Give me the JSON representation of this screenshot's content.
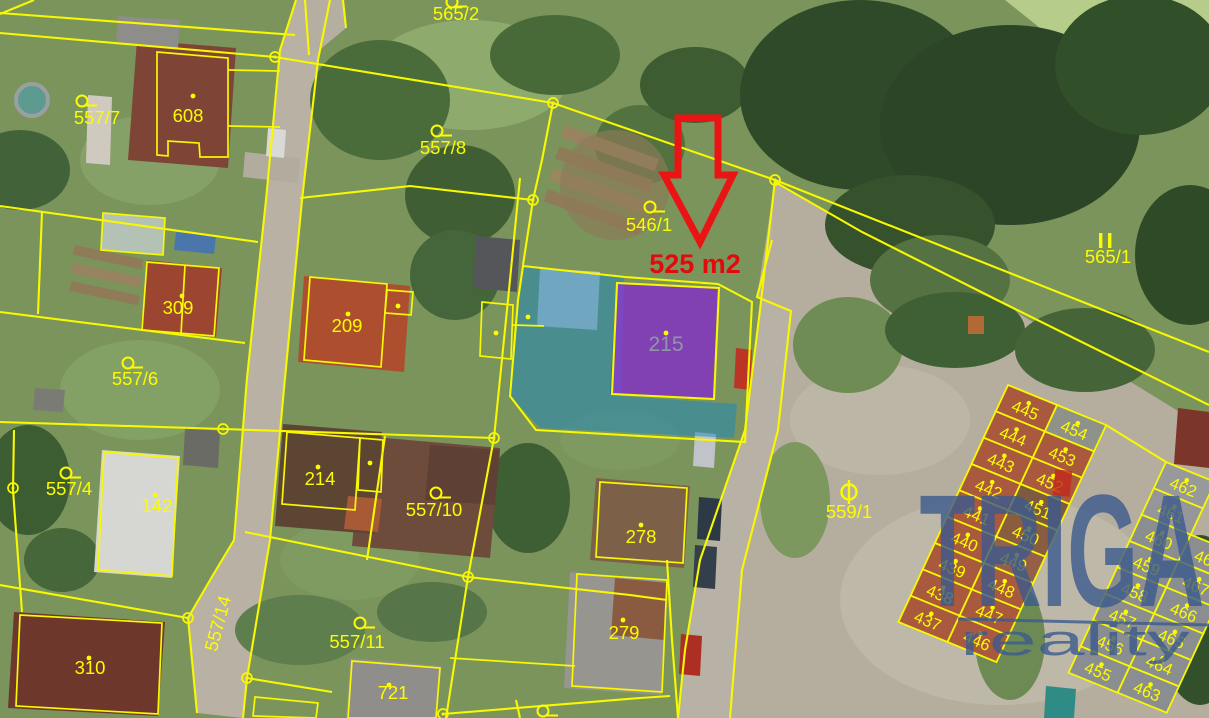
{
  "watermark": {
    "brand": "TRIGA",
    "sub": "reality",
    "color": "#3c5a8e",
    "accent": "#c2291d"
  },
  "highlight": {
    "area_text": "525 m2",
    "text_color": "#e10b0b",
    "arrow_color": "#ea1414"
  },
  "map": {
    "line_color": "#f8f800",
    "label_color": "#fcfc00",
    "labels": [
      {
        "t": "565/2",
        "x": 456,
        "y": 20,
        "s": "ring",
        "sx": 452,
        "sy": 2
      },
      {
        "t": "557/7",
        "x": 97,
        "y": 124,
        "s": "ring",
        "sx": 82,
        "sy": 101
      },
      {
        "t": "557/8",
        "x": 443,
        "y": 154,
        "s": "ring",
        "sx": 437,
        "sy": 131
      },
      {
        "t": "546/1",
        "x": 649,
        "y": 231,
        "s": "ring",
        "sx": 650,
        "sy": 207
      },
      {
        "t": "565/1",
        "x": 1108,
        "y": 263,
        "s": "bars",
        "sx": 1105,
        "sy": 241
      },
      {
        "t": "557/6",
        "x": 135,
        "y": 385,
        "s": "ring",
        "sx": 128,
        "sy": 363
      },
      {
        "t": "557/4",
        "x": 69,
        "y": 495,
        "s": "ring",
        "sx": 66,
        "sy": 473
      },
      {
        "t": "557/10",
        "x": 434,
        "y": 516,
        "s": "ring",
        "sx": 436,
        "sy": 493
      },
      {
        "t": "557/11",
        "x": 357,
        "y": 648,
        "s": "ring",
        "sx": 360,
        "sy": 623
      },
      {
        "t": "559/1",
        "x": 849,
        "y": 518,
        "s": "circle-bar",
        "sx": 849,
        "sy": 492
      },
      {
        "t": "557/14",
        "x": 224,
        "y": 625,
        "rot": -75
      },
      {
        "t": "608",
        "x": 188,
        "y": 122,
        "s": "dot",
        "sx": 193,
        "sy": 96
      },
      {
        "t": "309",
        "x": 178,
        "y": 314,
        "s": "dot",
        "sx": 182,
        "sy": 296
      },
      {
        "t": "209",
        "x": 347,
        "y": 332,
        "s": "dot",
        "sx": 348,
        "sy": 314
      },
      {
        "t": "215",
        "x": 666,
        "y": 351,
        "s": "dot",
        "sx": 666,
        "sy": 333,
        "c": "#8f97a6",
        "fs": 21
      },
      {
        "t": "142",
        "x": 157,
        "y": 512,
        "s": "dot",
        "sx": 155,
        "sy": 495
      },
      {
        "t": "214",
        "x": 320,
        "y": 485,
        "s": "dot",
        "sx": 318,
        "sy": 467
      },
      {
        "t": "278",
        "x": 641,
        "y": 543,
        "s": "dot",
        "sx": 641,
        "sy": 525
      },
      {
        "t": "279",
        "x": 624,
        "y": 639,
        "s": "dot",
        "sx": 623,
        "sy": 620
      },
      {
        "t": "721",
        "x": 393,
        "y": 699,
        "s": "dot",
        "sx": 389,
        "sy": 685
      },
      {
        "t": "310",
        "x": 90,
        "y": 674,
        "s": "dot",
        "sx": 89,
        "sy": 658
      },
      {
        "t": "",
        "x": 543,
        "y": 724,
        "s": "ring",
        "sx": 543,
        "sy": 711
      }
    ],
    "extra_dots": [
      [
        496,
        333
      ],
      [
        528,
        317
      ],
      [
        370,
        463
      ],
      [
        398,
        306
      ]
    ],
    "nodes": [
      [
        275,
        57
      ],
      [
        553,
        103
      ],
      [
        775,
        180
      ],
      [
        223,
        429
      ],
      [
        494,
        438
      ],
      [
        468,
        577
      ],
      [
        188,
        618
      ],
      [
        247,
        678
      ],
      [
        13,
        488
      ],
      [
        443,
        714
      ],
      [
        533,
        200
      ]
    ],
    "boundaries": [
      {
        "p": "0,13 295,35"
      },
      {
        "p": "0,33 275,57 553,103 775,180"
      },
      {
        "p": "775,180 1209,352"
      },
      {
        "p": "775,182 862,232 997,300 1209,405"
      },
      {
        "p": "296,0 280,50 266,200 247,378 234,540 213,575 188,618 197,713"
      },
      {
        "p": "330,0 318,60 302,200 285,378 270,540 247,678 243,718"
      },
      {
        "p": "0,206 258,242"
      },
      {
        "p": "0,312 245,343"
      },
      {
        "p": "0,422 223,429 494,438"
      },
      {
        "p": "0,585 188,618"
      },
      {
        "p": "14,430 13,490 22,612"
      },
      {
        "p": "157,52 228,58 228,157 200,157 199,143 168,141 168,156 157,155",
        "closed": true,
        "w": 1.7
      },
      {
        "p": "228,70 280,71",
        "w": 1.7
      },
      {
        "p": "228,126 280,127",
        "w": 1.7
      },
      {
        "p": "103,213 165,218 163,255 101,250",
        "closed": true,
        "w": 1.7
      },
      {
        "p": "42,212 38,314"
      },
      {
        "p": "147,262 219,268 214,336 142,330",
        "closed": true,
        "w": 1.7
      },
      {
        "p": "185,265 181,334",
        "w": 1.7
      },
      {
        "p": "310,277 387,284 381,367 304,360",
        "closed": true,
        "w": 1.7
      },
      {
        "p": "387,290 413,292 411,315 385,313",
        "closed": true,
        "w": 1.7
      },
      {
        "p": "300,198 410,186 533,200"
      },
      {
        "p": "520,178 508,300 494,438 468,577 446,718"
      },
      {
        "p": "553,103 542,160 533,200 523,265"
      },
      {
        "p": "523,266 625,277 718,284 752,302 745,442 536,430 510,396 518,300",
        "closed": true
      },
      {
        "p": "617,283 719,288 714,399 612,394",
        "closed": true
      },
      {
        "p": "482,302 513,305 511,359 480,356",
        "closed": true,
        "w": 1.7
      },
      {
        "p": "513,325 544,326",
        "w": 1.7
      },
      {
        "p": "468,577 630,595 667,600"
      },
      {
        "p": "667,560 672,640 678,718"
      },
      {
        "p": "443,714 640,698 670,696"
      },
      {
        "p": "450,658 575,666",
        "w": 1.7
      },
      {
        "p": "600,482 687,488 683,563 596,557",
        "closed": true,
        "w": 1.7
      },
      {
        "p": "577,574 667,580 662,692 572,686",
        "closed": true,
        "w": 1.7
      },
      {
        "p": "352,661 440,668 436,718 348,718",
        "closed": true,
        "w": 1.7
      },
      {
        "p": "20,615 162,623 158,714 16,706",
        "closed": true,
        "w": 1.7
      },
      {
        "p": "104,452 178,458 172,576 98,570",
        "closed": true,
        "w": 1.7
      },
      {
        "p": "287,432 360,438 355,510 282,504",
        "closed": true,
        "w": 1.7
      },
      {
        "p": "360,438 383,440 381,492 358,490",
        "closed": true,
        "w": 1.7
      },
      {
        "p": "245,532 468,577"
      },
      {
        "p": "385,436 367,560"
      },
      {
        "p": "255,697 318,703 316,718 253,716",
        "closed": true,
        "w": 1.7
      },
      {
        "p": "247,678 332,692"
      },
      {
        "p": "305,0 309,55"
      },
      {
        "p": "343,0 346,28"
      },
      {
        "p": "775,180 760,310 745,430 700,560 685,650 678,718"
      },
      {
        "p": "772,240 757,297 791,311 778,430 742,570 730,718"
      },
      {
        "p": "0,14 34,0"
      },
      {
        "p": "516,700 520,718"
      },
      {
        "p": "1106,425 1166,462"
      }
    ],
    "overlays": {
      "blue": {
        "points": "522,267 624,277 621,396 737,404 734,438 540,428 508,394",
        "fill": "#1f86bb",
        "opacity": 0.52
      },
      "purple": {
        "points": "617,284 718,288 714,399 612,395",
        "fill": "#8d3fd4",
        "opacity": 0.78
      }
    },
    "arrow": {
      "points": "678,118 718,118 718,175 733,175 700,242 664,175 678,175",
      "label_x": 695,
      "label_y": 273
    },
    "grids": [
      {
        "origin": [
          1008,
          385
        ],
        "u": [
          0.926,
          0.378
        ],
        "v": [
          -0.42,
          0.908
        ],
        "cw": 53,
        "rh": 29,
        "fill": "#a9593e",
        "overrides": {
          "454": "#8e9288",
          "451": "#7e5a40",
          "450": "#8a5d41",
          "449": "#95604a"
        },
        "rows": [
          [
            "445",
            "454"
          ],
          [
            "444",
            "453"
          ],
          [
            "443",
            "452"
          ],
          [
            "442",
            "451"
          ],
          [
            "441",
            "450"
          ],
          [
            "440",
            "449"
          ],
          [
            "439",
            "448"
          ],
          [
            "438",
            "447"
          ],
          [
            "437",
            "446"
          ]
        ]
      },
      {
        "origin": [
          1166,
          462
        ],
        "u": [
          0.926,
          0.378
        ],
        "v": [
          -0.42,
          0.908
        ],
        "cw": 53,
        "rh": 29,
        "fill": "#8b8e90",
        "overrides": {
          "462": "#97999b",
          "461": "#94969a"
        },
        "rows": [
          [
            "462",
            null
          ],
          [
            "461",
            null
          ],
          [
            "460",
            "468"
          ],
          [
            "459",
            "467"
          ],
          [
            "458",
            "466"
          ],
          [
            "457",
            "465"
          ],
          [
            "456",
            "464"
          ],
          [
            "455",
            "463"
          ]
        ]
      }
    ]
  }
}
